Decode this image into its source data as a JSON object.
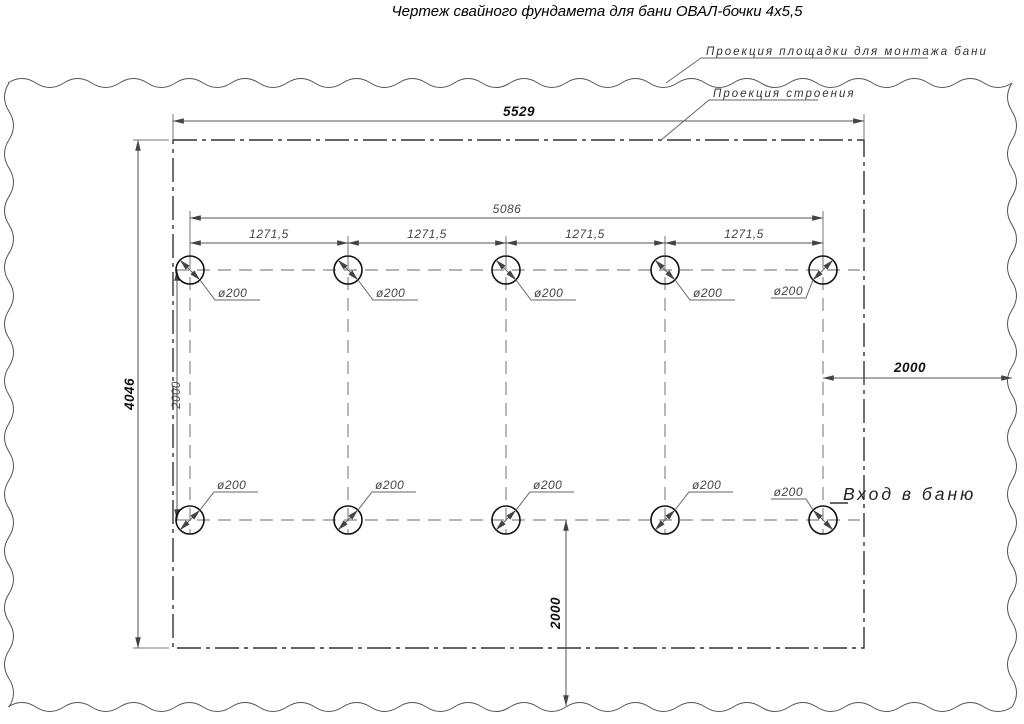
{
  "title": "Чертеж свайного фундамета для бани ОВАЛ-бочки 4х5,5",
  "callouts": {
    "platform": "Проекция площадки для монтажа бани",
    "building": "Проекция строения",
    "entrance": "Вход в баню"
  },
  "dimensions": {
    "overall_width": "5529",
    "overall_height": "4046",
    "pile_row_span": "5086",
    "pile_spacing": "1271,5",
    "row_distance": "2000",
    "right_offset": "2000",
    "bottom_offset": "2000",
    "pile_diameter": "ø200"
  }
}
